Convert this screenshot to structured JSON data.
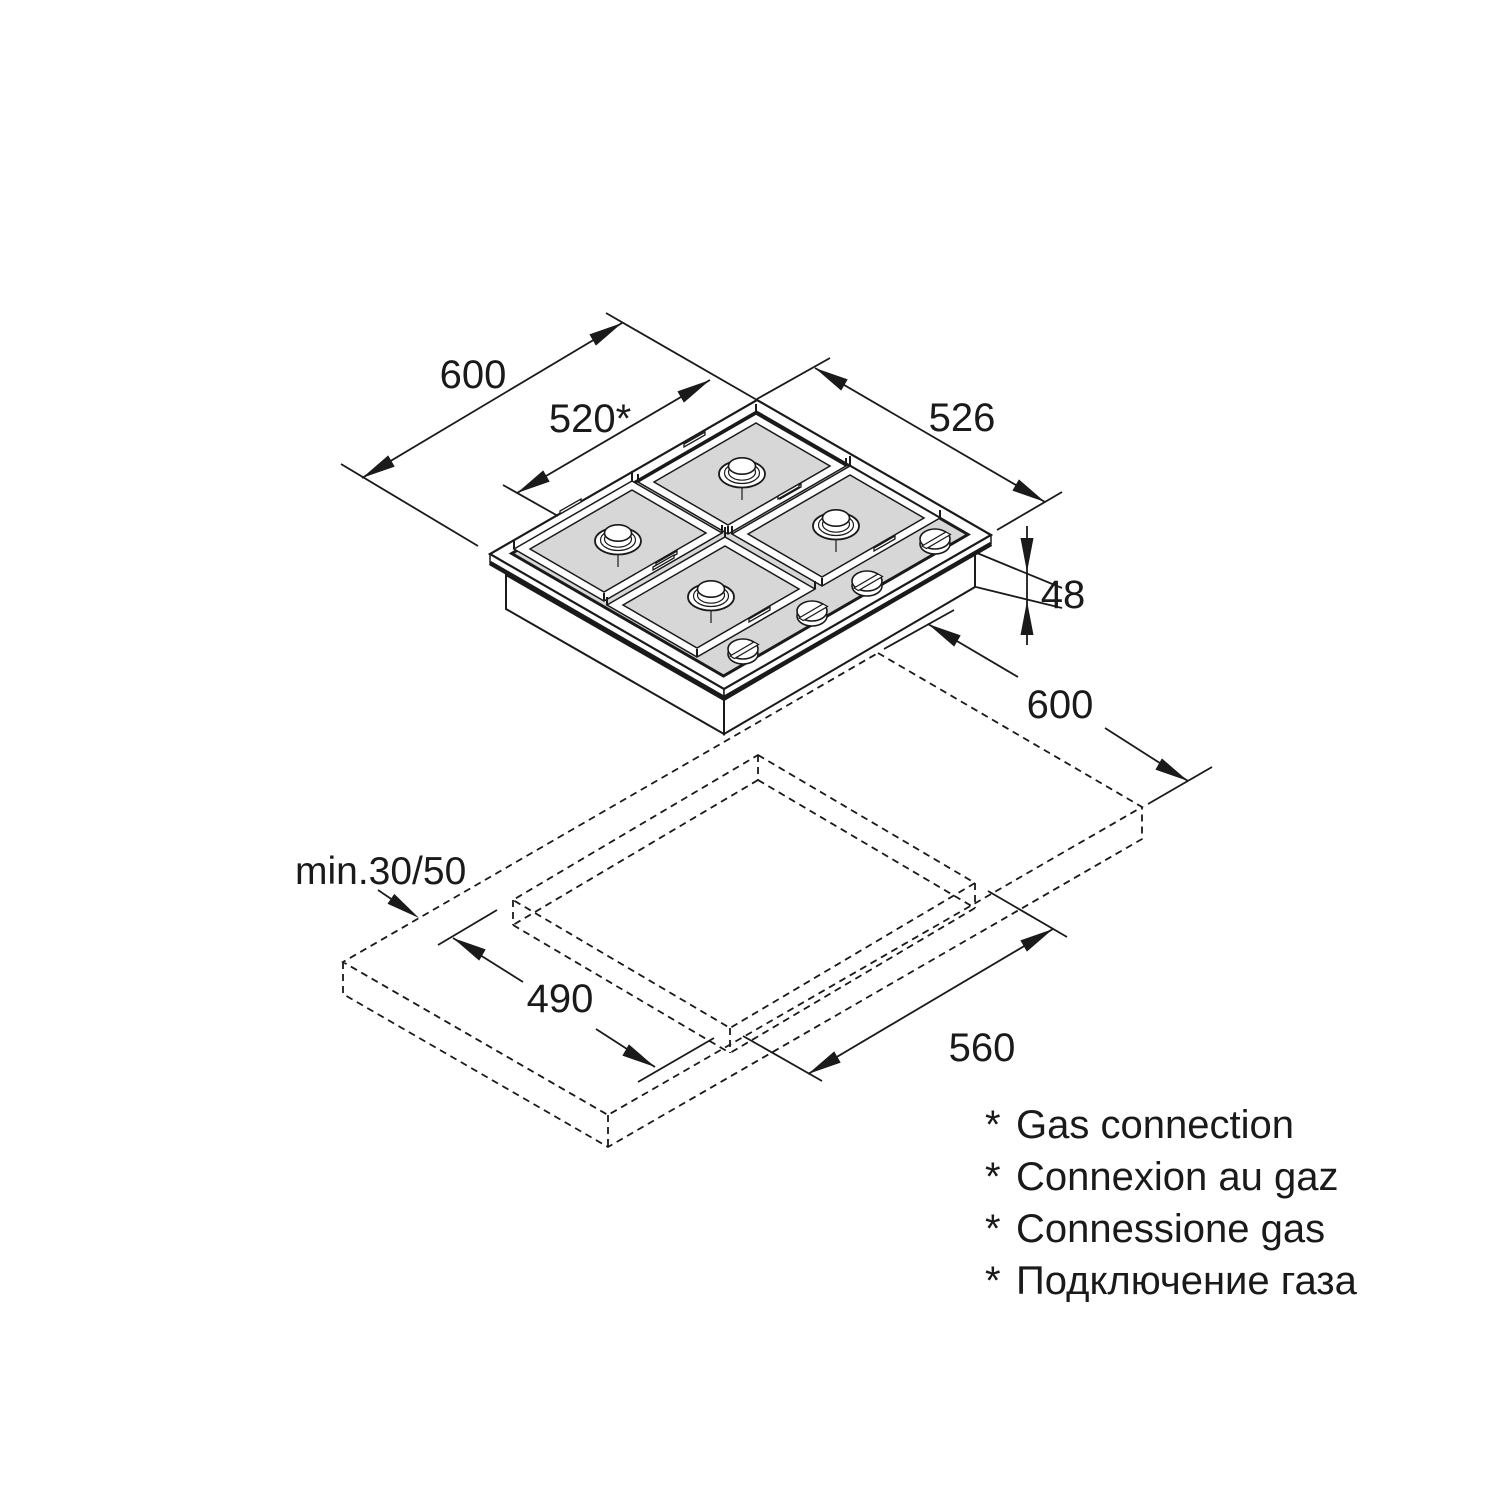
{
  "colors": {
    "background": "#ffffff",
    "line": "#1a1a1a",
    "hob_surface": "#d7d7d7"
  },
  "dimensions": {
    "hob_width": "600",
    "gas_connection_offset": "520*",
    "hob_depth": "526",
    "hob_height": "48",
    "worktop_depth": "600",
    "edge_clearance": "min.30/50",
    "cutout_depth": "490",
    "cutout_width": "560"
  },
  "footnotes": [
    {
      "marker": "*",
      "text": "Gas connection"
    },
    {
      "marker": "*",
      "text": "Connexion au gaz"
    },
    {
      "marker": "*",
      "text": "Connessione gas"
    },
    {
      "marker": "*",
      "text": "Подключение газа"
    }
  ]
}
